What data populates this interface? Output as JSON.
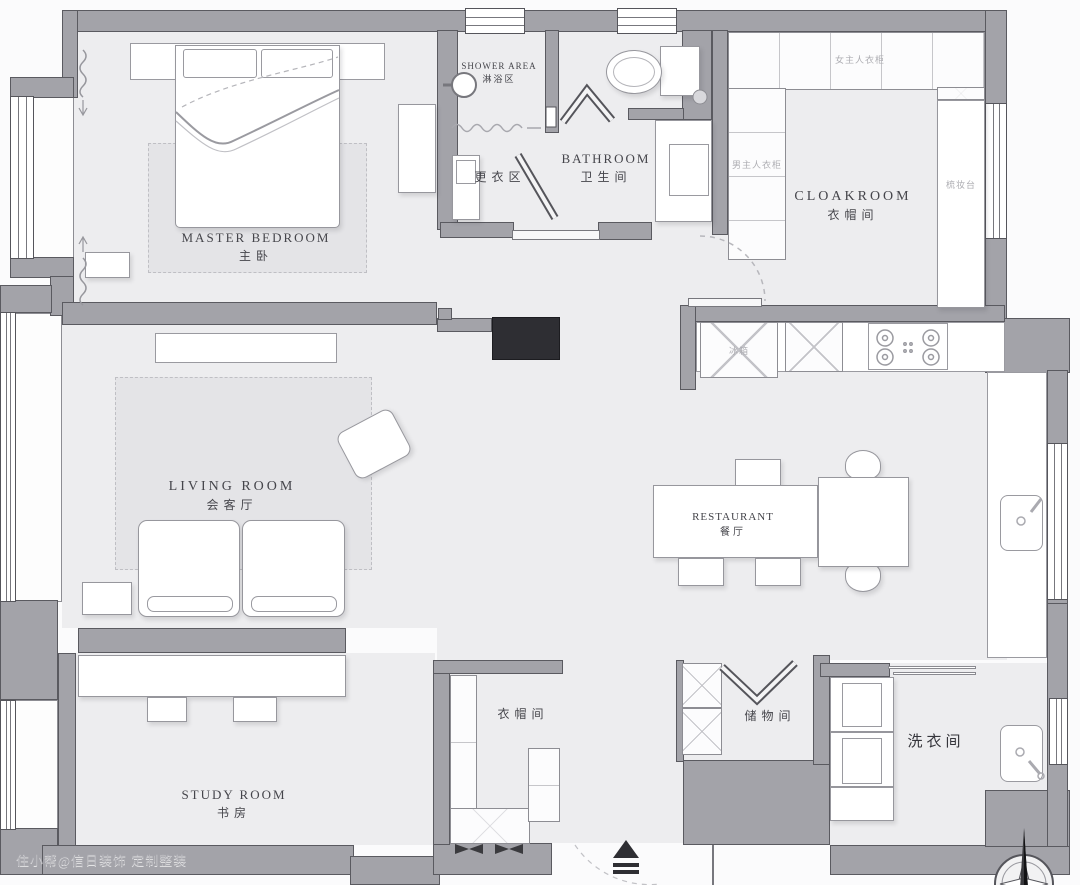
{
  "plan_title": "apartment floor plan",
  "rooms": {
    "master_bedroom": {
      "en": "MASTER BEDROOM",
      "zh": "主卧"
    },
    "shower_area": {
      "en": "SHOWER AREA",
      "zh": "淋浴区"
    },
    "dressing_area": {
      "zh": "更衣区"
    },
    "bathroom": {
      "en": "BATHROOM",
      "zh": "卫生间"
    },
    "cloakroom": {
      "en": "CLOAKROOM",
      "zh": "衣帽间"
    },
    "living_room": {
      "en": "LIVING ROOM",
      "zh": "会客厅"
    },
    "dining_room": {
      "en": "RESTAURANT",
      "zh": "餐厅"
    },
    "study_room": {
      "en": "STUDY ROOM",
      "zh": "书房"
    },
    "closet": {
      "zh": "衣帽间"
    },
    "storage": {
      "zh": "储物间"
    },
    "laundry": {
      "zh": "洗衣间"
    }
  },
  "labels": {
    "wife_wardrobe": "女主人衣柜",
    "husband_wardrobe": "男主人衣柜",
    "dressing_table": "梳妆台",
    "fridge": "冰箱"
  },
  "watermark": "住小帮@信日装饰 定制整装",
  "symbols": {
    "entry_arrow": "entrance direction",
    "compass": "north compass"
  },
  "colors": {
    "wall": "#a3a3a9",
    "floor": "#ededef",
    "dark_block": "#2e2e33",
    "line": "#5a5a60"
  }
}
